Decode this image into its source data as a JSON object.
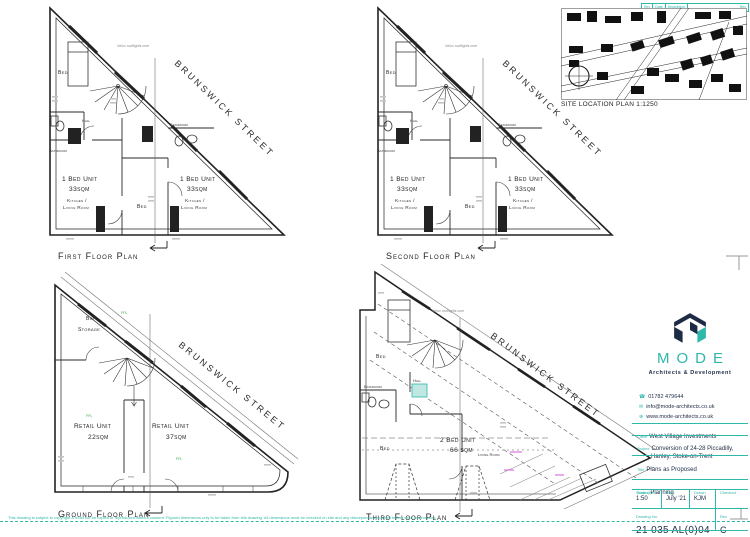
{
  "colors": {
    "teal": "#2eb8aa",
    "navy": "#1d2b45",
    "green": "#3aaa4a",
    "magenta": "#cf5bd6"
  },
  "revision_bar": {
    "rev": "Rev",
    "date": "Date",
    "description": "Description",
    "rev_right": "Rev"
  },
  "site_plan": {
    "caption": "SITE LOCATION PLAN 1:1250"
  },
  "icons": {
    "phone": "☎",
    "email": "✉",
    "web": "⊕"
  },
  "plans": {
    "first": {
      "caption": "First Floor Plan",
      "street": "BRUNSWICK STREET",
      "note": "Velux rooflights over",
      "rooms": {
        "bed": "Bed",
        "hall": "Hall",
        "bathroom_left": "Bathroom",
        "bathroom_right": "Bathroom",
        "bed_core": "Bed"
      },
      "unit_left": {
        "name": "1 Bed Unit",
        "area": "33sqm",
        "line1": "Kitchen /",
        "line2": "Living Room"
      },
      "unit_right": {
        "name": "1 Bed Unit",
        "area": "33sqm",
        "line1": "Kitchen /",
        "line2": "Living Room"
      }
    },
    "second": {
      "caption": "Second Floor Plan",
      "street": "BRUNSWICK STREET",
      "note": "Velux rooflights over",
      "rooms": {
        "bed": "Bed",
        "hall": "Hall",
        "bathroom_left": "Bathroom",
        "bathroom_right": "Bathroom",
        "bed_core": "Bed"
      },
      "unit_left": {
        "name": "1 Bed Unit",
        "area": "33sqm",
        "line1": "Kitchen /",
        "line2": "Living Room"
      },
      "unit_right": {
        "name": "1 Bed Unit",
        "area": "33sqm",
        "line1": "Kitchen /",
        "line2": "Living Room"
      }
    },
    "ground": {
      "caption": "Ground Floor Plan",
      "street": "BRUNSWICK STREET",
      "rooms": {
        "bin1": "Bin",
        "bin2": "Storage"
      },
      "unit_left": {
        "name": "Retail Unit",
        "area": "22sqm"
      },
      "unit_right": {
        "name": "Retail Unit",
        "area": "37sqm"
      },
      "levels": [
        "FFL",
        "FFL",
        "FFL"
      ]
    },
    "third": {
      "caption": "Third Floor Plan",
      "street": "BRUNSWICK STREET",
      "note": "Velux rooflights over",
      "rooms": {
        "bed_top": "Bed",
        "bathroom": "Bathroom",
        "hall": "Hall",
        "bed_mid": "Bed",
        "living": "Living Room"
      },
      "unit": {
        "name": "2 Bed Unit",
        "area": "66 sqm"
      }
    }
  },
  "titleblock": {
    "brand": "MODE",
    "tagline": "Architects & Development",
    "phone": "01782 479644",
    "email": "info@mode-architects.co.uk",
    "web": "www.mode-architects.co.uk",
    "labels": {
      "client": "Client",
      "project": "Project",
      "title": "Title",
      "status": "Status",
      "scale": "Scale @A1",
      "date": "Date",
      "drawn": "Drawn",
      "checked": "Checked",
      "drawing_no": "Drawing No.",
      "rev": "Rev"
    },
    "client": "West Village Investments",
    "project_1": "Conversion of 24-28 Piccadilly,",
    "project_2": "Hanley, Stoke-on-Trent",
    "title": "Plans as Proposed",
    "status": "Planning",
    "scale": "1:50",
    "date": "July '21",
    "drawn": "KJM",
    "checked": "",
    "drawing_no": "21 035 AL(0)04",
    "rev": "C"
  },
  "footer": {
    "disclaimer": "This drawing is subject to copyright & must not be copied or reproduced without consent. Figured dimensions only to be taken from this drawing. All dimensions must be checked on site and any discrepancies reported before work commences."
  }
}
